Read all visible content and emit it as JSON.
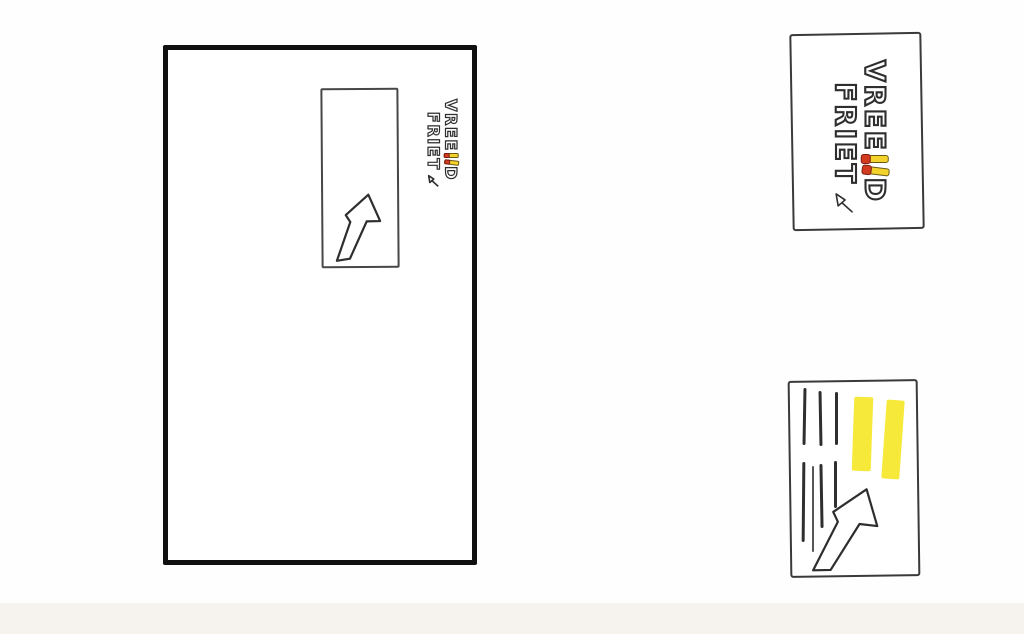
{
  "theme": {
    "ink": "#2e2e2e",
    "poster-border": "#101010",
    "card-border": "#3a3a3a",
    "fry": "#f2d22b",
    "fry-tip": "#d23b20",
    "highlight": "#f7e82f",
    "line": "#2f2f2f",
    "paper": "#fefefe",
    "paper-edge": "#f6f3ee"
  },
  "brand": {
    "word1_pre": "VREE",
    "word1_post": "D",
    "word2": "FRIET"
  },
  "icons": {
    "poster_arrow": "arrow-up-right",
    "flyer_arrow": "arrow-up-right",
    "logo_arrow": "arrow-doodle",
    "fries": "two-fries-with-ketchup-tips"
  }
}
